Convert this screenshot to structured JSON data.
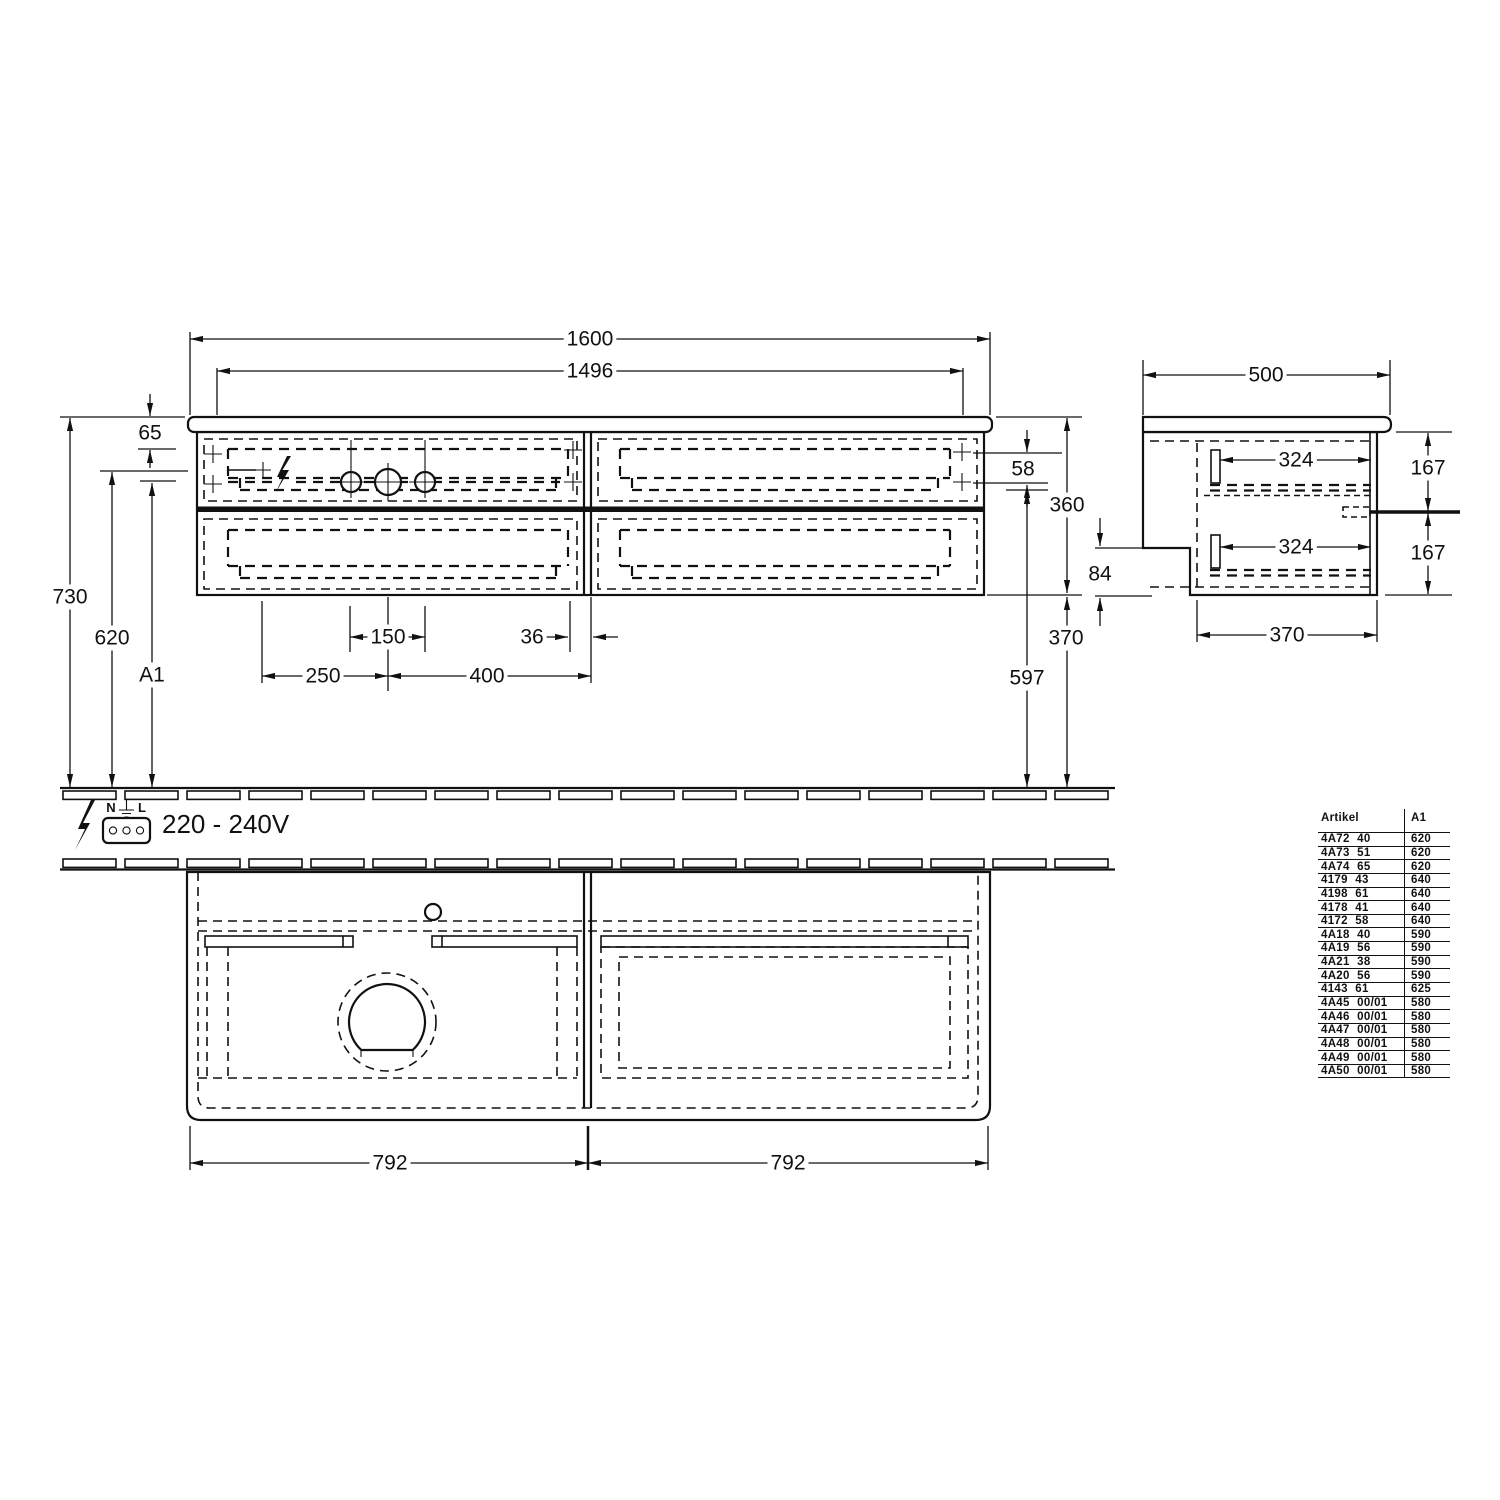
{
  "drawing": {
    "front": {
      "overall_width": "1600",
      "inner_width": "1496",
      "top_offset": "65",
      "total_height": "730",
      "outlet_height": "620",
      "variable_height": "A1",
      "drawer_gap": "58",
      "body_height": "360",
      "clearance_below": "370",
      "drain_height": "597",
      "hole_pitch": "150",
      "hole_edge": "36",
      "hole_left": "250",
      "hole_span": "400"
    },
    "side": {
      "depth": "500",
      "rail_top": "324",
      "rail_bottom": "324",
      "drawer_upper": "167",
      "drawer_lower": "167",
      "notch_height": "84",
      "bottom_depth": "370"
    },
    "plan": {
      "left_half": "792",
      "right_half": "792"
    },
    "electrical": {
      "terminal_n": "N",
      "terminal_l": "L",
      "voltage": "220 - 240V"
    },
    "table": {
      "header_article": "Artikel",
      "header_a1": "A1",
      "rows": [
        [
          "4A72 40",
          "620"
        ],
        [
          "4A73 51",
          "620"
        ],
        [
          "4A74 65",
          "620"
        ],
        [
          "4179 43",
          "640"
        ],
        [
          "4198 61",
          "640"
        ],
        [
          "4178 41",
          "640"
        ],
        [
          "4172 58",
          "640"
        ],
        [
          "4A18 40",
          "590"
        ],
        [
          "4A19 56",
          "590"
        ],
        [
          "4A21 38",
          "590"
        ],
        [
          "4A20 56",
          "590"
        ],
        [
          "4143 61",
          "625"
        ],
        [
          "4A45 00/01",
          "580"
        ],
        [
          "4A46 00/01",
          "580"
        ],
        [
          "4A47 00/01",
          "580"
        ],
        [
          "4A48 00/01",
          "580"
        ],
        [
          "4A49 00/01",
          "580"
        ],
        [
          "4A50 00/01",
          "580"
        ]
      ]
    }
  }
}
